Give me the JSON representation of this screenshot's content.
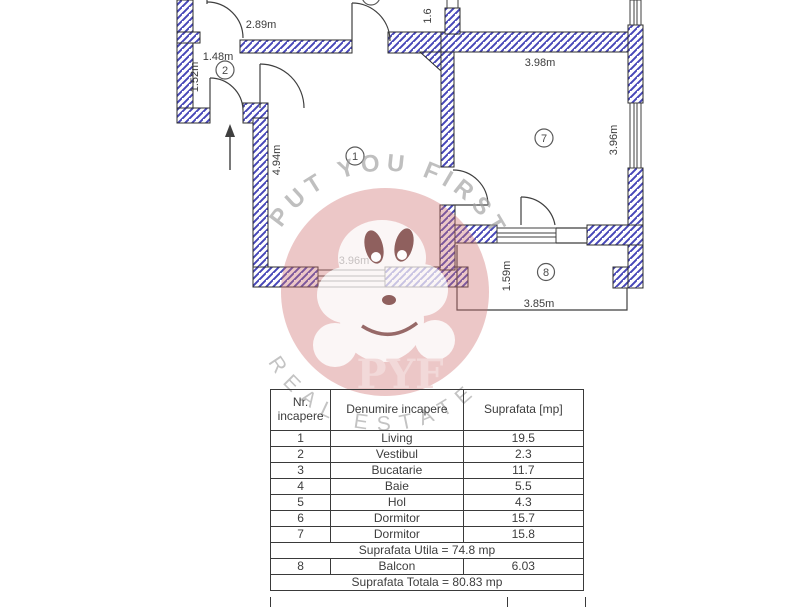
{
  "plan": {
    "labels": {
      "dim_289": "2.89m",
      "dim_148": "1.48m",
      "dim_152": "1.52m",
      "dim_16": "1.6",
      "dim_494": "4.94m",
      "dim_396_living": "3.96m",
      "dim_398": "3.98m",
      "dim_396_dorm": "3.96m",
      "dim_159": "1.59m",
      "dim_385": "3.85m"
    },
    "rooms": {
      "living": "1",
      "vestibul": "2",
      "dormitor": "7",
      "balcon": "8"
    },
    "colors": {
      "wall_hatch": "#4747b8",
      "wall_outline": "#2e2e2e",
      "thin_line": "#3f3f3f"
    }
  },
  "watermark": {
    "top_text": "PUT YOU FIRST",
    "logo_text": "PYF",
    "bottom_text": "REAL ESTATE",
    "brand_color": "#cf7070"
  },
  "table": {
    "headers": [
      "Nr. incapere",
      "Denumire incapere",
      "Suprafata [mp]"
    ],
    "rows": [
      [
        "1",
        "Living",
        "19.5"
      ],
      [
        "2",
        "Vestibul",
        "2.3"
      ],
      [
        "3",
        "Bucatarie",
        "11.7"
      ],
      [
        "4",
        "Baie",
        "5.5"
      ],
      [
        "5",
        "Hol",
        "4.3"
      ],
      [
        "6",
        "Dormitor",
        "15.7"
      ],
      [
        "7",
        "Dormitor",
        "15.8"
      ]
    ],
    "utila_row": "Suprafata Utila = 74.8 mp",
    "balcon_row": [
      "8",
      "Balcon",
      "6.03"
    ],
    "totala_row": "Suprafata Totala = 80.83 mp"
  }
}
